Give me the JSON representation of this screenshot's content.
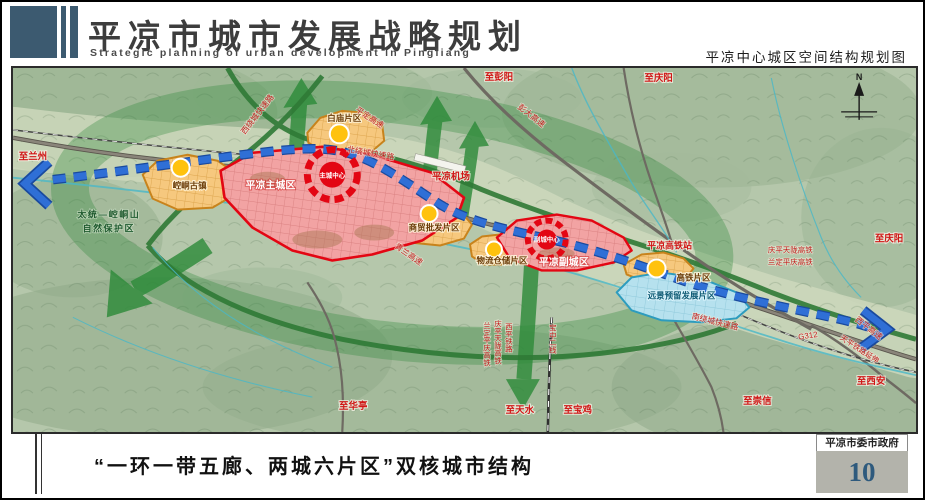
{
  "header": {
    "title_cn": "平凉市城市发展战略规划",
    "title_en": "Strategic planning of urban development in Pingliang",
    "map_subtitle": "平凉中心城区空间结构规划图"
  },
  "footer": {
    "caption": "“一环一带五廊、两城六片区”双核城市结构",
    "agency": "平凉市委市政府",
    "page_number": "10"
  },
  "map": {
    "compass": "N",
    "colors": {
      "eco_green": "#2e8a3a",
      "belt_blue": "#2f6fd6",
      "city_red": "#e30613",
      "district_orange": "#c8831c",
      "reserve_cyan": "#2d9cbe",
      "node_yellow": "#ffc20e",
      "label_red": "#d01616"
    },
    "labels": [
      {
        "t": "至兰州",
        "x": 20,
        "y": 92,
        "k": "dir"
      },
      {
        "t": "太统—崆峒山",
        "x": 96,
        "y": 150,
        "k": "nature"
      },
      {
        "t": "自然保护区",
        "x": 96,
        "y": 164,
        "k": "nature"
      },
      {
        "t": "崆峒古镇",
        "x": 177,
        "y": 121,
        "k": "zone"
      },
      {
        "t": "平凉主城区",
        "x": 258,
        "y": 121,
        "k": "zoneW"
      },
      {
        "t": "主城中心",
        "x": 320,
        "y": 110,
        "k": "core"
      },
      {
        "t": "白庙片区",
        "x": 332,
        "y": 53,
        "k": "zone"
      },
      {
        "t": "西绕城快速路",
        "x": 247,
        "y": 48,
        "k": "road",
        "r": -52
      },
      {
        "t": "平定高速",
        "x": 356,
        "y": 52,
        "k": "road",
        "r": 33
      },
      {
        "t": "北绕城快速路",
        "x": 358,
        "y": 88,
        "k": "road",
        "r": 10
      },
      {
        "t": "至彭阳",
        "x": 487,
        "y": 12,
        "k": "dir"
      },
      {
        "t": "彭大高速",
        "x": 518,
        "y": 50,
        "k": "road",
        "r": 38
      },
      {
        "t": "至庆阳",
        "x": 647,
        "y": 13,
        "k": "dir"
      },
      {
        "t": "平凉机场",
        "x": 439,
        "y": 112,
        "k": "dir"
      },
      {
        "t": "青兰高速",
        "x": 395,
        "y": 189,
        "k": "road",
        "r": 35
      },
      {
        "t": "商贸批发片区",
        "x": 422,
        "y": 163,
        "k": "zone",
        "s": 8
      },
      {
        "t": "物流仓储片区",
        "x": 490,
        "y": 196,
        "k": "zone",
        "s": 8
      },
      {
        "t": "副城中心",
        "x": 535,
        "y": 174,
        "k": "core",
        "s": 6
      },
      {
        "t": "平凉副城区",
        "x": 552,
        "y": 198,
        "k": "zoneW",
        "s": 9
      },
      {
        "t": "平凉高铁站",
        "x": 658,
        "y": 181,
        "k": "station"
      },
      {
        "t": "庆平天陇高铁",
        "x": 779,
        "y": 185,
        "k": "rail"
      },
      {
        "t": "兰定平庆高铁",
        "x": 779,
        "y": 197,
        "k": "rail"
      },
      {
        "t": "至庆阳",
        "x": 878,
        "y": 174,
        "k": "dir"
      },
      {
        "t": "高铁片区",
        "x": 682,
        "y": 213,
        "k": "zone",
        "s": 8
      },
      {
        "t": "远景预留发展片区",
        "x": 670,
        "y": 231,
        "k": "zoneC"
      },
      {
        "t": "南绕城快速路",
        "x": 703,
        "y": 257,
        "k": "road",
        "r": 14
      },
      {
        "t": "G312",
        "x": 797,
        "y": 271,
        "k": "road",
        "r": -8
      },
      {
        "t": "西平高速",
        "x": 856,
        "y": 263,
        "k": "road",
        "r": 38
      },
      {
        "t": "天平铁路延伸",
        "x": 847,
        "y": 284,
        "k": "rail",
        "r": 33
      },
      {
        "t": "至西安",
        "x": 860,
        "y": 317,
        "k": "dir"
      },
      {
        "t": "至崇信",
        "x": 746,
        "y": 337,
        "k": "dir"
      },
      {
        "t": "至华亭",
        "x": 341,
        "y": 342,
        "k": "dir"
      },
      {
        "t": "至天水",
        "x": 508,
        "y": 346,
        "k": "dir"
      },
      {
        "t": "至宝鸡",
        "x": 566,
        "y": 346,
        "k": "dir"
      },
      {
        "t": "西平铁路",
        "x": 497,
        "y": 262,
        "k": "rail",
        "v": 1
      },
      {
        "t": "庆平天陇高铁",
        "x": 486,
        "y": 259,
        "k": "rail",
        "v": 1,
        "s": 7
      },
      {
        "t": "兰定平庆高铁",
        "x": 475,
        "y": 261,
        "k": "rail",
        "v": 1,
        "s": 7
      },
      {
        "t": "宝中二线",
        "x": 541,
        "y": 263,
        "k": "rail",
        "v": 1
      }
    ]
  }
}
